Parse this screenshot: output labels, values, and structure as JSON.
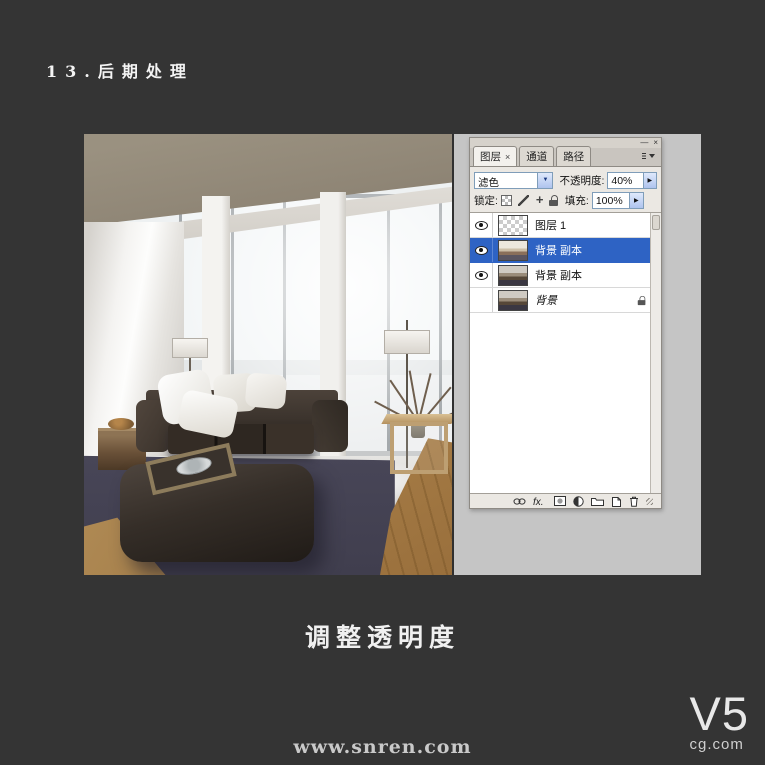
{
  "page": {
    "title": "13.后期处理",
    "caption": "调整透明度",
    "watermark": "www.snren.com",
    "logo_big": "V5",
    "logo_small": "cg.com"
  },
  "panel": {
    "window": {
      "minimize": "—",
      "close": "×"
    },
    "tabs": [
      {
        "label": "图层",
        "close": "×",
        "active": true
      },
      {
        "label": "通道",
        "active": false
      },
      {
        "label": "路径",
        "active": false
      }
    ],
    "blend_mode_value": "滤色",
    "opacity_label": "不透明度:",
    "opacity_value": "40%",
    "lock_label": "锁定:",
    "fill_label": "填充:",
    "fill_value": "100%",
    "layers": [
      {
        "name": "图层 1",
        "visible": true,
        "thumb": "checker",
        "selected": false,
        "locked": false
      },
      {
        "name": "背景 副本",
        "visible": true,
        "thumb": "photo-bright",
        "selected": true,
        "locked": false
      },
      {
        "name": "背景 副本",
        "visible": true,
        "thumb": "photo-dark",
        "selected": false,
        "locked": false
      },
      {
        "name": "背景",
        "visible": false,
        "thumb": "photo-dark",
        "selected": false,
        "locked": true
      }
    ],
    "footer_icons": [
      "link-icon",
      "layer-style-icon",
      "layer-mask-icon",
      "adjustment-layer-icon",
      "layer-group-icon",
      "new-layer-icon",
      "delete-layer-icon"
    ]
  },
  "colors": {
    "background": "#343434",
    "selection_blue": "#2e63c4",
    "workspace_gray": "#c5c5c5"
  }
}
